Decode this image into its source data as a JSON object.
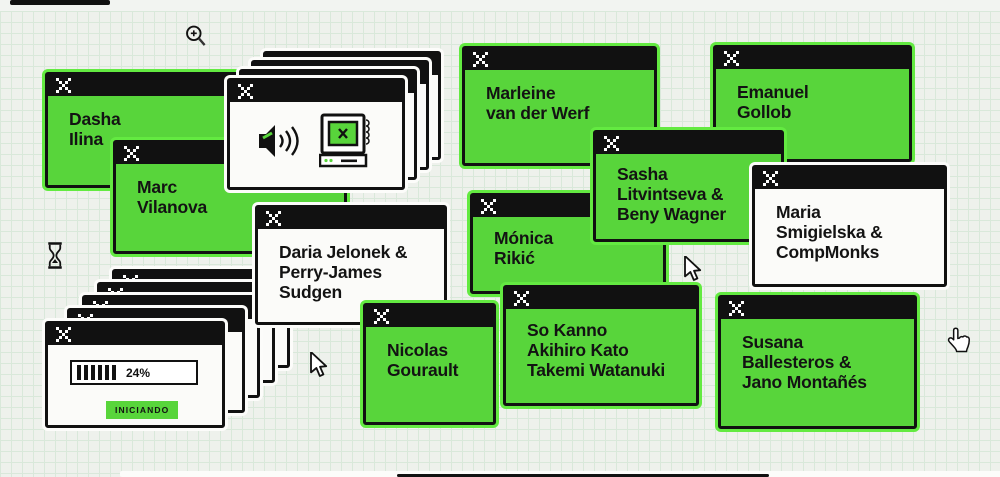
{
  "scene": {
    "description": "Retro OS windows collage on graph paper listing artist names",
    "colors": {
      "window_green": "#58d53b",
      "green_outline": "#63ea41",
      "titlebar_black": "#111111",
      "paper": "#eef1ec",
      "grid_line": "#d9e8da",
      "window_white": "#fbfbf9"
    }
  },
  "windows": [
    {
      "id": "dasha",
      "lines": [
        "Dasha",
        "Ilina"
      ]
    },
    {
      "id": "marc",
      "lines": [
        "Marc",
        "Vilanova"
      ]
    },
    {
      "id": "marleine",
      "lines": [
        "Marleine",
        "van der Werf"
      ]
    },
    {
      "id": "emanuel",
      "lines": [
        "Emanuel",
        "Gollob"
      ]
    },
    {
      "id": "monica",
      "lines": [
        "Mónica",
        "Rikić"
      ]
    },
    {
      "id": "sasha",
      "lines": [
        "Sasha",
        "Litvintseva &",
        "Beny Wagner"
      ]
    },
    {
      "id": "maria",
      "lines": [
        "Maria",
        "Smigielska &",
        "CompMonks"
      ]
    },
    {
      "id": "daria",
      "lines": [
        "Daria Jelonek &",
        "Perry-James",
        "Sudgen"
      ]
    },
    {
      "id": "nicolas",
      "lines": [
        "Nicolas",
        "Gourault"
      ]
    },
    {
      "id": "so_kanno",
      "lines": [
        "So Kanno",
        "Akihiro Kato",
        "Takemi Watanuki"
      ]
    },
    {
      "id": "susana",
      "lines": [
        "Susana",
        "Ballesteros &",
        "Jano Montañés"
      ]
    }
  ],
  "loader": {
    "progress_label": "24%",
    "button_label": "INICIANDO"
  },
  "icons": {
    "close": "pixel-x",
    "speaker": "pixel speaker with sound waves",
    "monitor": "retro computer with green screen and x",
    "hourglass": "wait cursor",
    "zoom": "magnifier zoom-in cursor",
    "arrow": "arrow pointer cursor",
    "hand": "hand pointer cursor"
  }
}
